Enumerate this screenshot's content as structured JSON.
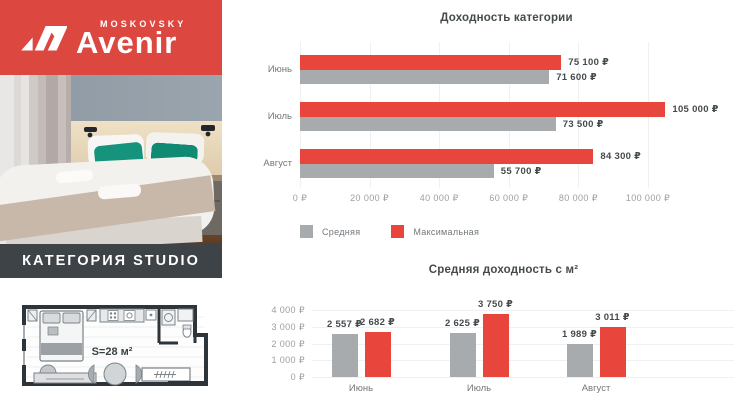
{
  "brand": {
    "top_label": "MOSKOVSKY",
    "name": "Avenir",
    "logo_icon": "av-monogram",
    "banner_color": "#dc4740"
  },
  "category_banner": {
    "label": "КАТЕГОРИЯ STUDIO",
    "bg": "#3e4347"
  },
  "photo": {
    "alt": "hotel studio bedroom with teal pillows"
  },
  "floorplan": {
    "area_label": "S=28 м²"
  },
  "colors": {
    "red": "#e8453d",
    "gray": "#a8abae",
    "text_dark": "#454a4d",
    "text_gray": "#73787b",
    "tick_gray": "#999fa2"
  },
  "chart_data": [
    {
      "type": "bar",
      "orientation": "horizontal",
      "title": "Доходность категории",
      "categories": [
        "Июнь",
        "Июль",
        "Август"
      ],
      "series": [
        {
          "name": "Максимальная",
          "color": "#e8453d",
          "values": [
            75100,
            105000,
            84300
          ],
          "labels": [
            "75 100 ₽",
            "105 000 ₽",
            "84 300 ₽"
          ]
        },
        {
          "name": "Средняя",
          "color": "#a8abae",
          "values": [
            71600,
            73500,
            55700
          ],
          "labels": [
            "71 600 ₽",
            "73 500 ₽",
            "55 700 ₽"
          ]
        }
      ],
      "xlim": [
        0,
        100000
      ],
      "x_ticks": [
        "0 ₽",
        "20 000 ₽",
        "40 000 ₽",
        "60 000 ₽",
        "80 000 ₽",
        "100 000 ₽"
      ],
      "legend": [
        {
          "name": "Средняя",
          "color": "#a8abae"
        },
        {
          "name": "Максимальная",
          "color": "#e8453d"
        }
      ],
      "grid": "vertical"
    },
    {
      "type": "bar",
      "orientation": "vertical",
      "title": "Средняя доходность с м²",
      "categories": [
        "Июнь",
        "Июль",
        "Август"
      ],
      "series": [
        {
          "name": "Средняя",
          "color": "#a8abae",
          "values": [
            2557,
            2625,
            1989
          ],
          "labels": [
            "2 557 ₽",
            "2 625 ₽",
            "1 989 ₽"
          ]
        },
        {
          "name": "Максимальная",
          "color": "#e8453d",
          "values": [
            2682,
            3750,
            3011
          ],
          "labels": [
            "2 682 ₽",
            "3 750 ₽",
            "3 011 ₽"
          ]
        }
      ],
      "ylim": [
        0,
        4000
      ],
      "y_ticks": [
        "4 000 ₽",
        "3 000 ₽",
        "2 000 ₽",
        "1 000 ₽",
        "0 ₽"
      ],
      "grid": "horizontal"
    }
  ]
}
